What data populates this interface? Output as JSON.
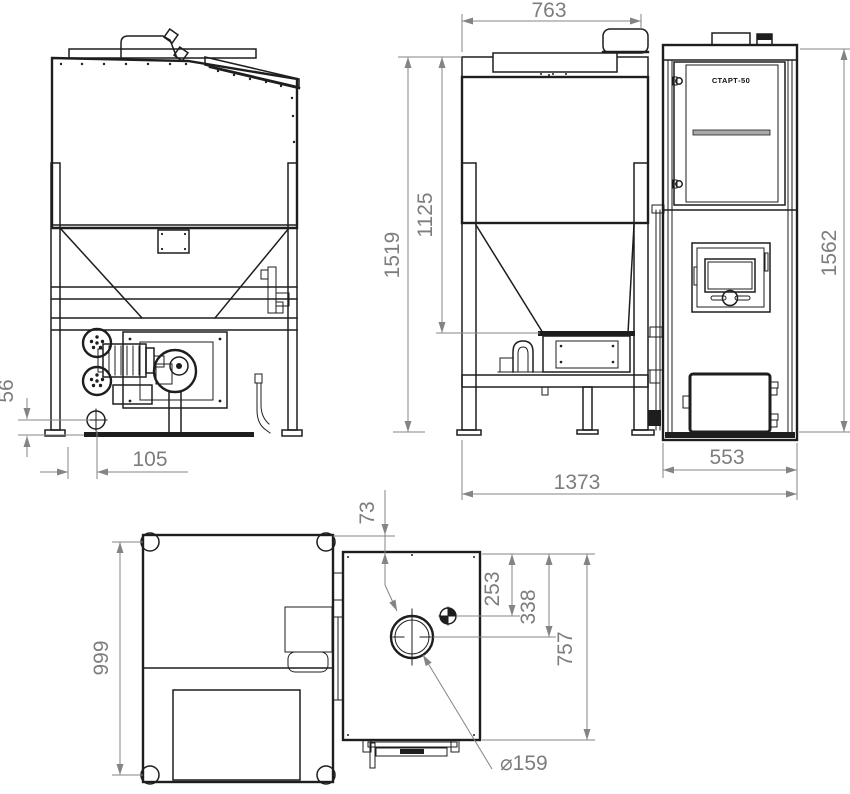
{
  "drawing": {
    "type": "engineering-dimension-drawing",
    "subject": "pellet boiler with fuel hopper - three orthographic views and top view",
    "colors": {
      "background": "#ffffff",
      "line": "#1e1e1e",
      "dimension": "#7d7d7d"
    },
    "labels": {
      "boiler_model": "СТАРТ-50"
    },
    "dimensions": {
      "front_drain_height": "56",
      "front_drain_offset": "105",
      "hopper_top_width": "763",
      "hopper_total_height": "1519",
      "hopper_funnel_height": "1125",
      "assembly_total_length": "1373",
      "boiler_width": "553",
      "boiler_height": "1562",
      "top_edge_offset": "73",
      "hopper_depth": "999",
      "bolt_offset": "253",
      "chimney_offset": "338",
      "boiler_depth": "757",
      "chimney_diameter": "⌀159"
    }
  }
}
